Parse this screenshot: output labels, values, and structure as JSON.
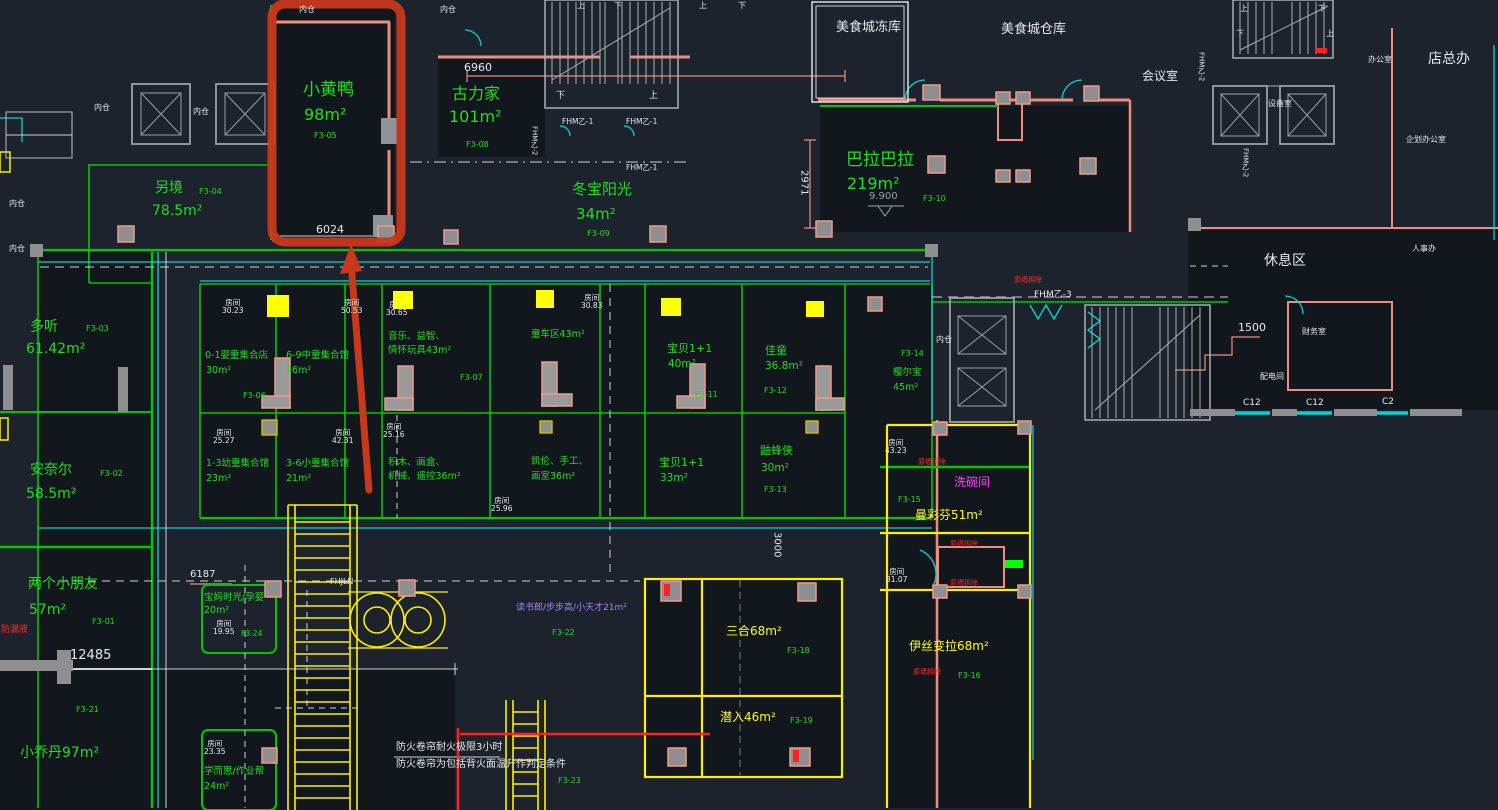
{
  "colors": {
    "background": "#1d232c",
    "cad_green": "#17e317",
    "cad_yellow": "#ffff00",
    "cad_cyan": "#00e8e8",
    "cad_magenta": "#ff3dff",
    "cad_violet": "#9d86ff",
    "cad_red": "#ff2a2a",
    "wall_pink": "#ec8d7d",
    "highlight_red": "#c8381b"
  },
  "plan": {
    "shops": [
      {
        "name": "小黄鸭",
        "area": "98m²",
        "code": "F3-05"
      },
      {
        "name": "古力家",
        "area": "101m²",
        "code": "F3-08"
      },
      {
        "name": "冬宝阳光",
        "area": "34m²",
        "code": "F3-09"
      },
      {
        "name": "巴拉巴拉",
        "area": "219m²",
        "code": "F3-10"
      },
      {
        "name": "另境",
        "area": "78.5m²",
        "code": "F3-04"
      },
      {
        "name": "多听",
        "area": "61.42m²",
        "code": "F3-03"
      },
      {
        "name": "安奈尔",
        "area": "58.5m²",
        "code": "F3-02"
      },
      {
        "name": "两个小朋友",
        "area": "57m²",
        "code": "F3-01"
      },
      {
        "name": "小乔丹97m²",
        "area": "",
        "code": "F3-21"
      },
      {
        "name": "0-1婴童集合店",
        "area": "30m²",
        "code": "F3-06"
      },
      {
        "name": "1-3幼童集合馆",
        "area": "23m²",
        "code": ""
      },
      {
        "name": "6-9中童集合馆",
        "area": "26m²",
        "code": ""
      },
      {
        "name": "3-6小童集合馆",
        "area": "21m²",
        "code": ""
      },
      {
        "name": "音乐、益智、",
        "area": "情怀玩具43m²",
        "code": ""
      },
      {
        "name": "积木、画盒、",
        "area": "机械、遥控36m²",
        "code": ""
      },
      {
        "name": "童车区43m²",
        "area": "",
        "code": "F3-07"
      },
      {
        "name": "凯伦、手工、",
        "area": "画室36m²",
        "code": ""
      },
      {
        "name": "宝贝1+1",
        "area": "40m²",
        "code": "F3-11"
      },
      {
        "name": "宝贝1+1",
        "area": "33m²",
        "code": ""
      },
      {
        "name": "佳童",
        "area": "36.8m²",
        "code": "F3-12"
      },
      {
        "name": "鼬蜂侠",
        "area": "30m²",
        "code": "F3-13"
      },
      {
        "name": "樱尔宝",
        "area": "45m²",
        "code": "F3-14"
      },
      {
        "name": "曼彩芬51m²",
        "area": "",
        "code": "F3-15"
      },
      {
        "name": "伊丝变拉68m²",
        "area": "",
        "code": "F3-16"
      },
      {
        "name": "三合68m²",
        "area": "",
        "code": "F3-18"
      },
      {
        "name": "潜入46m²",
        "area": "",
        "code": "F3-19"
      },
      {
        "name": "宝妈时光/孕婴",
        "area": "20m²",
        "code": "F3-24"
      },
      {
        "name": "学而思/作业帮",
        "area": "24m²",
        "code": ""
      },
      {
        "name": "读书郎/步步高/小天才21m²",
        "area": "",
        "code": "F3-22"
      },
      {
        "name": "",
        "area": "",
        "code": "F3-23"
      }
    ],
    "rooms": {
      "label": "房间",
      "values": [
        "30.23",
        "50.53",
        "30.65",
        "25.27",
        "42.31",
        "25.16",
        "30.83",
        "25.96",
        "43.23",
        "31.07",
        "19.95",
        "23.35"
      ]
    },
    "offices": {
      "dongku": "美食城冻库",
      "cangku": "美食城仓库",
      "huiyishi": "会议室",
      "dianzongban": "店总办",
      "bangongshi": "办公室",
      "shebeishi": "设备室",
      "qihua": "企划办公室",
      "xiuxiqu": "休息区",
      "renshiban": "人事办",
      "caiwushi": "财务室",
      "peidianjian": "配电间",
      "xiwanjian": "洗碗间"
    },
    "dims": {
      "w6960": "6960",
      "w6024": "6024",
      "w6187": "6187",
      "w12485": "12485",
      "v2971": "2971",
      "v3000": "3000",
      "w1500": "1500",
      "lvl": "9.900"
    },
    "notes": {
      "fire1": "防火卷帘耐火极限3小时",
      "fire2": "防火卷帘为包括背火面温升作判定条件",
      "demolish": "原墙拆除",
      "leak": "防漏液"
    },
    "tech": {
      "fhm1": "FHM乙-1",
      "fhm2": "FHM乙-2",
      "fhm3": "FHM乙-3",
      "fhjln": "FHJLN",
      "neicang": "内仓",
      "up": "上",
      "down": "下",
      "c12": "C12",
      "c2": "C2"
    }
  }
}
